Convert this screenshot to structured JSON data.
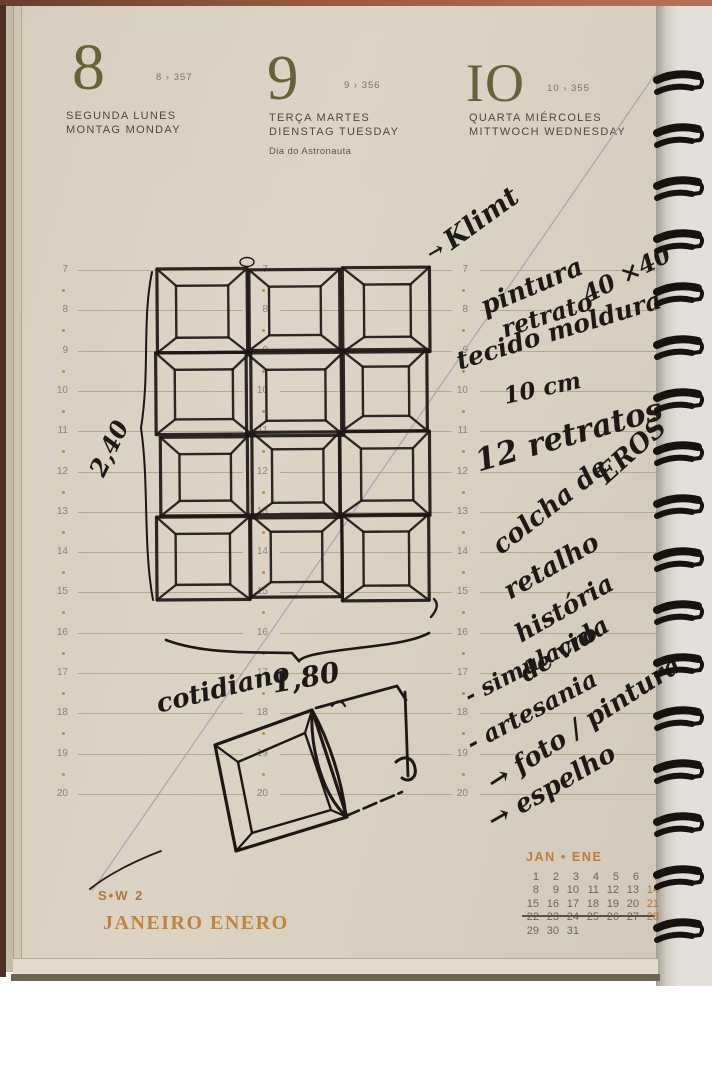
{
  "page": {
    "days": [
      {
        "number": "8",
        "info": "8 › 357",
        "lines": "SEGUNDA  LUNES\nMONTAG  MONDAY",
        "note": ""
      },
      {
        "number": "9",
        "info": "9 › 356",
        "lines": "TERÇA  MARTES\nDIENSTAG  TUESDAY",
        "note": "Dia do Astronauta"
      },
      {
        "number": "IO",
        "info": "10 › 355",
        "lines": "QUARTA  MIÉRCOLES\nMITTWOCH  WEDNESDAY",
        "note": ""
      }
    ],
    "hours": [
      7,
      8,
      9,
      10,
      11,
      12,
      13,
      14,
      15,
      16,
      17,
      18,
      19,
      20
    ],
    "week_label": "S•W 2",
    "month_label": "JANEIRO  ENERO",
    "mini_calendar": {
      "title": "JAN • ENE",
      "rows": [
        [
          "1",
          "2",
          "3",
          "4",
          "5",
          "6",
          "7"
        ],
        [
          "8",
          "9",
          "10",
          "11",
          "12",
          "13",
          "14"
        ],
        [
          "15",
          "16",
          "17",
          "18",
          "19",
          "20",
          "21"
        ],
        [
          "22",
          "23",
          "24",
          "25",
          "26",
          "27",
          "28"
        ],
        [
          "29",
          "30",
          "31",
          "",
          "",
          "",
          ""
        ]
      ],
      "highlight_days": [
        "7",
        "14",
        "21",
        "28"
      ],
      "underlined_week": "8–14"
    }
  },
  "handwriting": {
    "klimt_arrow": "→",
    "klimt": "Klimt",
    "pintura": "pintura",
    "dims4040": "40 ×40",
    "retrato": "retrato",
    "tecido": "tecido moldura",
    "tencm": "10 cm",
    "retratos12": "12 retratos",
    "eros": "EROS",
    "colcha": "colcha de",
    "retalho": "retalho",
    "historia": "história",
    "devida": "de vida",
    "simulacro": "- simulacro",
    "artesania": "- artesania",
    "foto": "→ foto / pintura",
    "espelho": "→ espelho",
    "cotidiano": "cotidiano",
    "height_dim": "2,40",
    "width_dim": "1,80"
  },
  "colors": {
    "paper": "#d7cfc0",
    "day_number_olive": "#65633a",
    "orange_accent": "#bf7d35",
    "hour_line": "#b6a78a",
    "ink": "#1c1a17",
    "pencil_line": "#a2a3b4",
    "spiral": "#16130f"
  }
}
